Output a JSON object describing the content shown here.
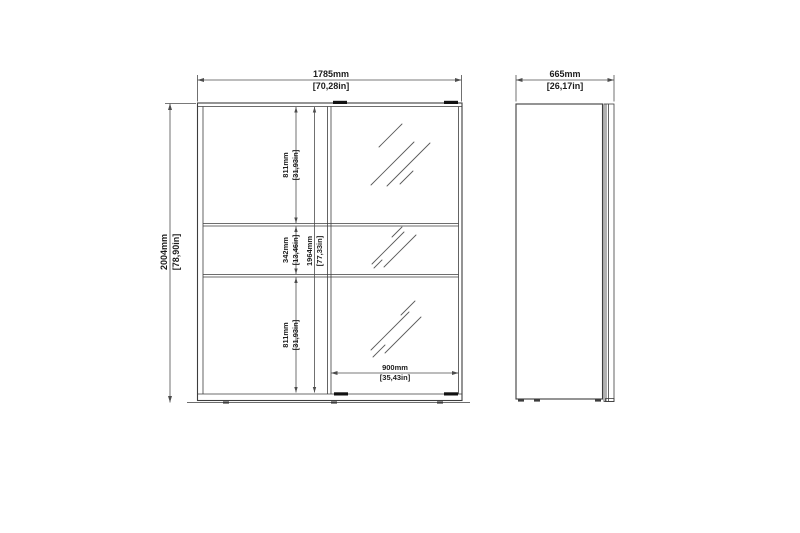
{
  "drawing": {
    "type": "wardrobe dimensioned technical drawing, front and side view",
    "front_view": {
      "width": {
        "mm": "1785mm",
        "in": "[70,28in]"
      },
      "height": {
        "mm": "2004mm",
        "in": "[78,90in]"
      },
      "interior_height": {
        "mm": "1964mm",
        "in": "[77,33in]"
      },
      "sections": {
        "top": {
          "mm": "811mm",
          "in": "[31,93in]"
        },
        "middle": {
          "mm": "342mm",
          "in": "[13,46in]"
        },
        "bottom": {
          "mm": "811mm",
          "in": "[31,93in]"
        }
      },
      "door_width": {
        "mm": "900mm",
        "in": "[35,43in]"
      }
    },
    "side_view": {
      "depth": {
        "mm": "665mm",
        "in": "[26,17in]"
      }
    },
    "colors": {
      "background": "#ffffff",
      "line": "#3d3d3d",
      "dimension": "#4d4d4d",
      "hatch": "#5a5a5a",
      "roller": "#111111",
      "text": "#1c1c1c"
    }
  }
}
